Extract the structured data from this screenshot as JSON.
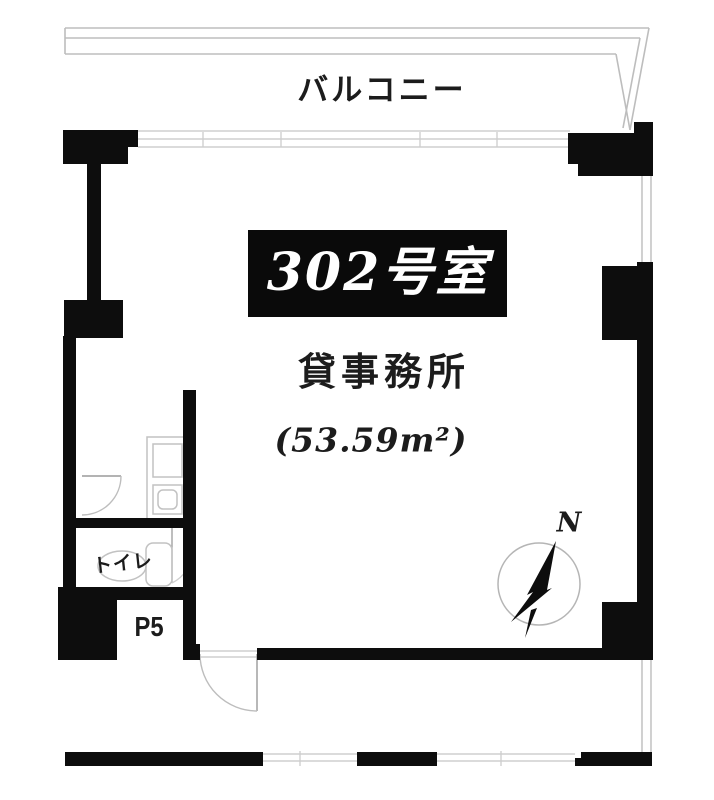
{
  "labels": {
    "balcony": "バルコニー",
    "room_number": "302号室",
    "room_use": "貸事務所",
    "room_area": "(53.59m²)",
    "toilet": "トイレ",
    "pipe_space": "P5",
    "compass_north": "N"
  },
  "colors": {
    "wall": "#0d0d0d",
    "line": "#bdbdbd",
    "text": "#1c1c1c",
    "room_label_bg": "#0a0a0a",
    "room_label_fg": "#ffffff",
    "background": "#ffffff"
  }
}
